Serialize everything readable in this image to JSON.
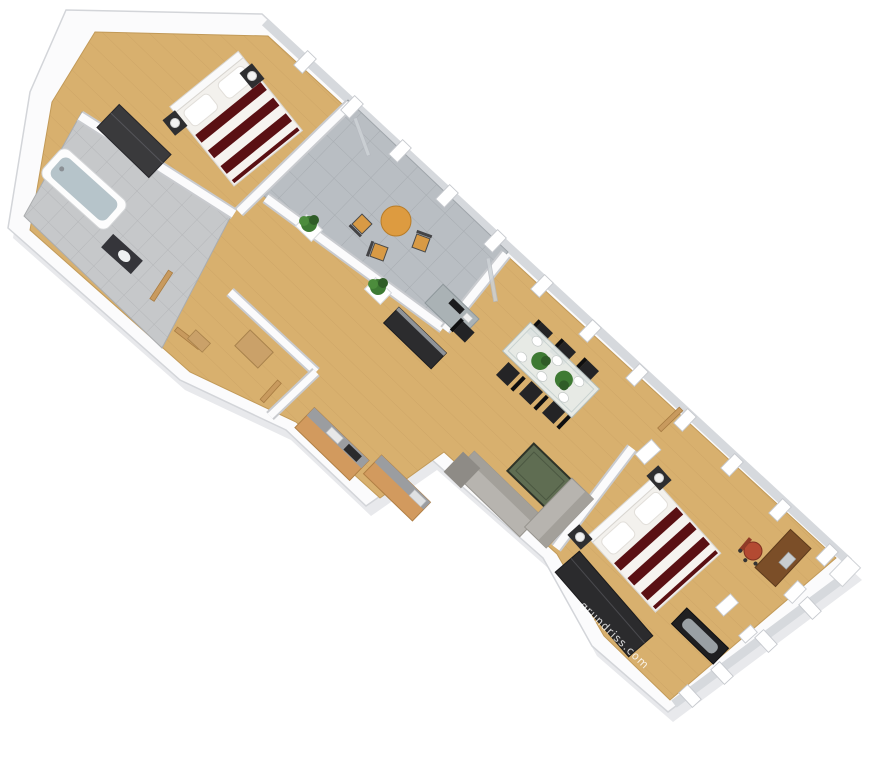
{
  "meta": {
    "description": "3D isometric rendering of a long, diagonally oriented two-bedroom apartment floor plan on a white background"
  },
  "watermark": {
    "text": "grundriss.com"
  },
  "palette": {
    "background": "#ffffff",
    "wall_top": "#fbfbfc",
    "wall_edge": "#d3d5d9",
    "wall_shadow": "#e8e9ec",
    "glass": "#d6d9dd",
    "wood_floor": "#d8b06e",
    "tile_terrace": "#b9bec3",
    "tile_bath": "#c6c8ca",
    "furniture_dark": "#2c2c2e",
    "bed_red": "#5a1013",
    "bed_white": "#f3f1ed",
    "sofa_gray": "#b7b4af",
    "coffee_table_green": "#5f6d52",
    "terrace_table_orange": "#dd9b40",
    "glass_table": "#e8eeec",
    "desk_wood": "#7b4e28",
    "office_chair_red": "#b34a32",
    "door_wood": "#c89a5e",
    "plant_green": "#3e7a33",
    "watermark_white": "#ffffff"
  },
  "rooms": [
    {
      "name": "bedroom-1",
      "furniture": [
        "double bed with red striped duvet",
        "two nightstands with lamps",
        "dark wardrobe"
      ]
    },
    {
      "name": "bathroom",
      "furniture": [
        "bathtub",
        "washbasin counter"
      ]
    },
    {
      "name": "terrace",
      "furniture": [
        "round orange table",
        "three bistro chairs",
        "two potted plants on parapet"
      ]
    },
    {
      "name": "hallway",
      "furniture": [
        "open wooden doors",
        "storage cabinet"
      ]
    },
    {
      "name": "kitchen",
      "furniture": [
        "counter with sink",
        "counter with stove"
      ]
    },
    {
      "name": "living-dining",
      "furniture": [
        "glass dining table with six black chairs",
        "corner sofa",
        "green coffee table",
        "computer desk with chair",
        "dark sideboard"
      ]
    },
    {
      "name": "bedroom-2",
      "furniture": [
        "double bed with red striped duvet",
        "two nightstands with lamps",
        "dark wardrobe",
        "dark chaise bench",
        "wooden desk with red office chair"
      ]
    }
  ]
}
